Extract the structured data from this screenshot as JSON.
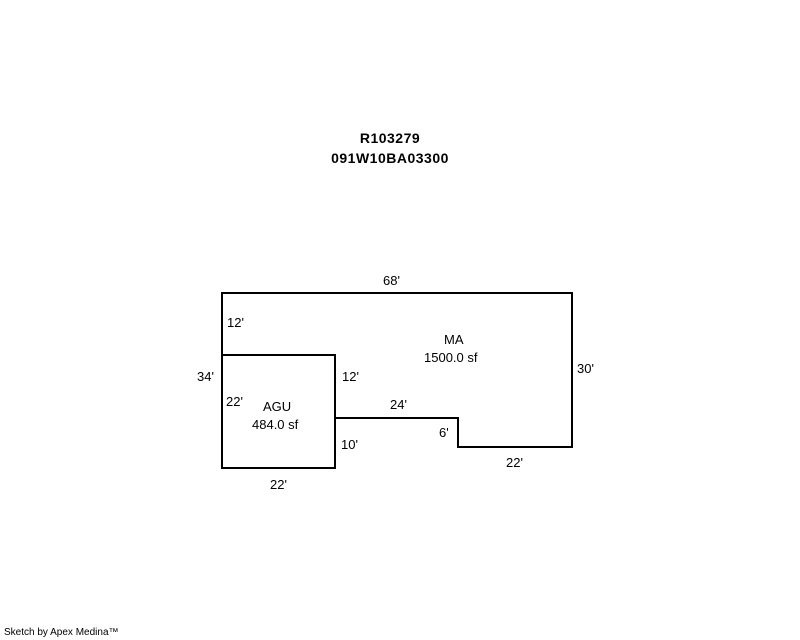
{
  "header": {
    "parcel_id": "R103279",
    "parcel_number": "091W10BA03300"
  },
  "sketch": {
    "line_color": "#000000",
    "outline_points": "222,293 572,293 572,447 458,447 458,418 335,418 335,468 222,468",
    "agu_points": "222,355 335,355 335,468 222,468",
    "areas": {
      "ma": {
        "code": "MA",
        "size": "1500.0 sf"
      },
      "agu": {
        "code": "AGU",
        "size": "484.0 sf"
      }
    },
    "dims": {
      "top": "68'",
      "left_upper": "12'",
      "left_total": "34'",
      "agu_left": "22'",
      "agu_right_upper": "12'",
      "notch_top": "24'",
      "notch_step": "6'",
      "agu_right_lower": "10'",
      "right": "30'",
      "bottom_right": "22'",
      "agu_bottom": "22'"
    }
  },
  "footer": {
    "credit": "Sketch by Apex Medina™"
  }
}
